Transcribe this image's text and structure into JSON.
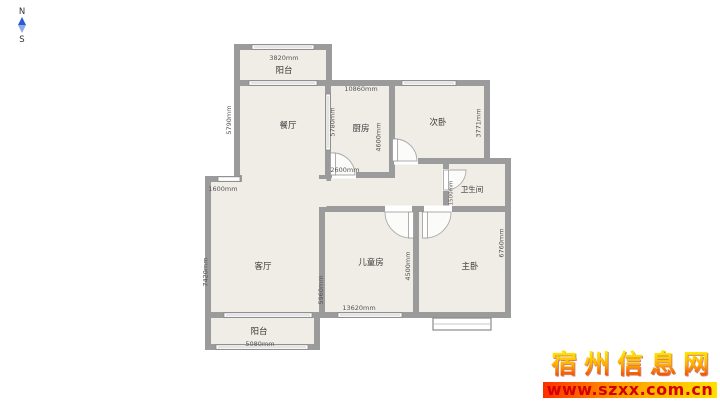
{
  "compass": {
    "north": "N",
    "south": "S"
  },
  "rooms": {
    "balcony_top": "阳台",
    "dining": "餐厅",
    "kitchen": "厨房",
    "bedroom2": "次卧",
    "bathroom": "卫生间",
    "children": "儿童房",
    "master": "主卧",
    "living": "客厅",
    "balcony_bottom": "阳台"
  },
  "dims": {
    "balcony_top_width": "3820mm",
    "dining_left_height": "5790mm",
    "kitchen_top_width": "10860mm",
    "kitchen_left_height": "5780mm",
    "kitchen_right_height": "4600mm",
    "kitchen_bottom_width": "2600mm",
    "bedroom2_right_height": "3771mm",
    "bathroom_left_height": "1500mm",
    "living_top_width": "1600mm",
    "living_left_height": "7420mm",
    "living_right_height": "5960mm",
    "children_right_height": "4500mm",
    "children_bottom_width": "13620mm",
    "master_right_height": "6760mm",
    "balcony_bottom_width": "5080mm"
  },
  "watermark": {
    "site_name": "宿州信息网",
    "site_url": "www.szxx.com.cn"
  },
  "colors": {
    "wall": "#9b9b9b",
    "room_fill": "#f0ede6",
    "compass_blue_dark": "#2a5bd7",
    "compass_blue_light": "#8fa9e4",
    "watermark_red": "#d40000",
    "watermark_yellow": "#ffe000"
  }
}
